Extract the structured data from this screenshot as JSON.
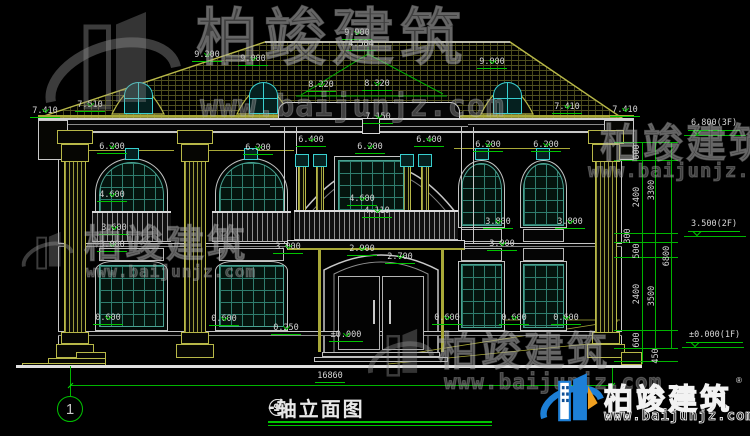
{
  "colors": {
    "dim_line": "#00c400",
    "dim_text": "#d6d6d6",
    "trim_yellow": "#b8b848",
    "window_teal": "#2f7d6e",
    "accent_cyan": "#38cfcf",
    "logo_blue": "#1d7fd6",
    "logo_orange": "#f0a020"
  },
  "watermark": {
    "brand": "柏竣建筑",
    "url": "www.baijunjz.com"
  },
  "logo": {
    "brand": "柏竣建筑",
    "url": "www.baijunjz.com",
    "reg": "®"
  },
  "title": {
    "axis_from": "1",
    "axis_dash": "—",
    "axis_to": "9",
    "text": "轴立面图"
  },
  "axis_bubble": {
    "label": "1"
  },
  "bottom_dim": {
    "text": "16860",
    "x": 330,
    "y": 372
  },
  "dims": [
    {
      "t": "9.900",
      "x": 357,
      "y": 29,
      "lvl": true
    },
    {
      "t": "4.584",
      "x": 361,
      "y": 40
    },
    {
      "t": "9.200",
      "x": 207,
      "y": 51,
      "lvl": true
    },
    {
      "t": "9.000",
      "x": 253,
      "y": 55,
      "lvl": true
    },
    {
      "t": "9.000",
      "x": 492,
      "y": 58,
      "lvl": true
    },
    {
      "t": "8.220",
      "x": 321,
      "y": 81,
      "lvl": true
    },
    {
      "t": "8.320",
      "x": 377,
      "y": 80,
      "lvl": true
    },
    {
      "t": "7.150",
      "x": 378,
      "y": 113,
      "lvl": true
    },
    {
      "t": "7.410",
      "x": 45,
      "y": 107,
      "lvl": true
    },
    {
      "t": "7.510",
      "x": 90,
      "y": 101,
      "lvl": true
    },
    {
      "t": "7.410",
      "x": 567,
      "y": 103,
      "lvl": true
    },
    {
      "t": "7.410",
      "x": 625,
      "y": 106,
      "lvl": true
    },
    {
      "t": "6.200",
      "x": 112,
      "y": 143,
      "lvl": true
    },
    {
      "t": "6.200",
      "x": 258,
      "y": 144,
      "lvl": true
    },
    {
      "t": "6.400",
      "x": 311,
      "y": 136,
      "lvl": true
    },
    {
      "t": "6.200",
      "x": 370,
      "y": 143,
      "lvl": true
    },
    {
      "t": "6.400",
      "x": 429,
      "y": 136,
      "lvl": true
    },
    {
      "t": "6.200",
      "x": 488,
      "y": 141,
      "lvl": true
    },
    {
      "t": "6.200",
      "x": 546,
      "y": 141,
      "lvl": true
    },
    {
      "t": "4.600",
      "x": 112,
      "y": 191,
      "lvl": true
    },
    {
      "t": "4.600",
      "x": 362,
      "y": 195,
      "lvl": true
    },
    {
      "t": "4.110",
      "x": 377,
      "y": 207,
      "lvl": true
    },
    {
      "t": "3.600",
      "x": 114,
      "y": 224,
      "lvl": true
    },
    {
      "t": "3.800",
      "x": 498,
      "y": 218,
      "lvl": true
    },
    {
      "t": "3.800",
      "x": 570,
      "y": 218,
      "lvl": true
    },
    {
      "t": "3.000",
      "x": 112,
      "y": 241,
      "lvl": true
    },
    {
      "t": "3.000",
      "x": 288,
      "y": 243,
      "lvl": true
    },
    {
      "t": "3.000",
      "x": 502,
      "y": 240,
      "lvl": true
    },
    {
      "t": "2.900",
      "x": 362,
      "y": 245,
      "lvl": true
    },
    {
      "t": "2.700",
      "x": 400,
      "y": 253,
      "lvl": true
    },
    {
      "t": "0.600",
      "x": 108,
      "y": 314,
      "lvl": true
    },
    {
      "t": "0.600",
      "x": 224,
      "y": 315,
      "lvl": true
    },
    {
      "t": "0.250",
      "x": 286,
      "y": 324,
      "lvl": true
    },
    {
      "t": "±0.000",
      "x": 346,
      "y": 331,
      "lvl": true
    },
    {
      "t": "0.600",
      "x": 447,
      "y": 314,
      "lvl": true
    },
    {
      "t": "0.600",
      "x": 514,
      "y": 314,
      "lvl": true
    },
    {
      "t": "0.600",
      "x": 566,
      "y": 314,
      "lvl": true
    }
  ],
  "vchain": [
    {
      "t": "600",
      "x": 637,
      "y": 152
    },
    {
      "t": "2400",
      "x": 637,
      "y": 197
    },
    {
      "t": "300",
      "x": 628,
      "y": 236
    },
    {
      "t": "500",
      "x": 637,
      "y": 251
    },
    {
      "t": "2400",
      "x": 637,
      "y": 294
    },
    {
      "t": "600",
      "x": 637,
      "y": 340
    },
    {
      "t": "450",
      "x": 656,
      "y": 356
    },
    {
      "t": "3300",
      "x": 652,
      "y": 190
    },
    {
      "t": "3500",
      "x": 652,
      "y": 296
    },
    {
      "t": "6800",
      "x": 667,
      "y": 256
    }
  ],
  "levels_right": [
    {
      "t": "6.800(3F)",
      "x": 688,
      "y": 119
    },
    {
      "t": "3.500(2F)",
      "x": 688,
      "y": 220
    },
    {
      "t": "±0.000(1F)",
      "x": 686,
      "y": 331
    }
  ]
}
